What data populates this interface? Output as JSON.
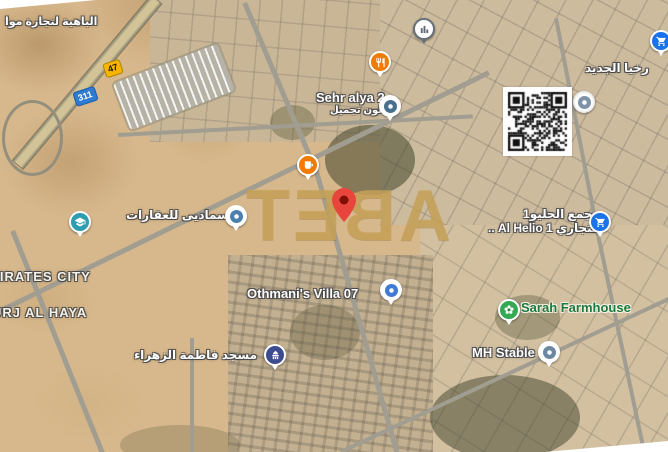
{
  "app": {
    "type": "satellite-map-view"
  },
  "watermark": {
    "text": "TEBA",
    "letters": [
      "T",
      "E",
      "B",
      "A"
    ],
    "color": "#c8a35c"
  },
  "route_badges": [
    {
      "number": "47",
      "style": "highway-yellow"
    },
    {
      "number": "311",
      "style": "route-blue"
    }
  ],
  "labels": [
    {
      "name": "label-al-bahia-trading",
      "text": "الباهية لتجارة موا",
      "x": 5,
      "y": 15,
      "size": 11,
      "style": "white",
      "rtl": true
    },
    {
      "name": "label-sehr-alya-2",
      "text": "Sehr alya 2",
      "x": 316,
      "y": 90,
      "size": 13,
      "style": "white"
    },
    {
      "name": "label-sehr-alya-2-ar",
      "text": "صالون تجميل",
      "x": 330,
      "y": 105,
      "size": 10,
      "style": "white",
      "rtl": true
    },
    {
      "name": "label-al-jadeed",
      "text": "رخيا الجديد",
      "x": 585,
      "y": 61,
      "size": 12,
      "style": "white",
      "rtl": true
    },
    {
      "name": "label-majma-al-helio-1",
      "text": "مجمع الحليو1",
      "x": 523,
      "y": 207,
      "size": 12,
      "style": "white",
      "rtl": true
    },
    {
      "name": "label-al-helio-1-commercial",
      "text": "التجاري Al Helio 1 ..",
      "x": 488,
      "y": 221,
      "size": 12,
      "style": "white",
      "rtl": true
    },
    {
      "name": "label-samadi-real-estate",
      "text": "سماديى للعقارات",
      "x": 126,
      "y": 208,
      "size": 12,
      "style": "white",
      "rtl": true
    },
    {
      "name": "label-emirates-city",
      "text": "MIRATES CITY",
      "x": -12,
      "y": 269,
      "size": 13,
      "style": "city"
    },
    {
      "name": "label-burj-al-haya",
      "text": "URJ AL HAYA",
      "x": -8,
      "y": 305,
      "size": 13,
      "style": "city"
    },
    {
      "name": "label-othmanis-villa-07",
      "text": "Othmani's Villa 07",
      "x": 247,
      "y": 286,
      "size": 13,
      "style": "white"
    },
    {
      "name": "label-fatima-alzahra-mosque",
      "text": "مسجد فاطمة الزهراء",
      "x": 134,
      "y": 348,
      "size": 12,
      "style": "white",
      "rtl": true
    },
    {
      "name": "label-sarah-farmhouse",
      "text": "Sarah Farmhouse",
      "x": 521,
      "y": 300,
      "size": 13,
      "style": "green"
    },
    {
      "name": "label-mh-stable",
      "text": "MH Stable",
      "x": 472,
      "y": 345,
      "size": 13,
      "style": "white"
    }
  ],
  "markers": [
    {
      "name": "building-poi-marker",
      "icon": "building-icon",
      "x": 424,
      "y": 29,
      "bg": "#ffffff",
      "ring": "#667078",
      "iconColor": "#5c6670"
    },
    {
      "name": "restaurant-marker",
      "icon": "restaurant-icon",
      "x": 380,
      "y": 62,
      "bg": "#f07c02",
      "ring": "#ffffff",
      "iconColor": "#ffffff"
    },
    {
      "name": "cafe-marker",
      "icon": "cafe-icon",
      "x": 308,
      "y": 165,
      "bg": "#f07c02",
      "ring": "#ffffff",
      "iconColor": "#ffffff"
    },
    {
      "name": "sehr-alya-pin",
      "icon": "dot-icon",
      "x": 390,
      "y": 106,
      "bg": "#ffffff",
      "ring": "#ffffff",
      "iconColor": "#47708c"
    },
    {
      "name": "school-marker",
      "icon": "school-icon",
      "x": 80,
      "y": 222,
      "bg": "#2d9db0",
      "ring": "#ffffff",
      "iconColor": "#ffffff"
    },
    {
      "name": "samadi-pin",
      "icon": "dot-icon",
      "x": 236,
      "y": 216,
      "bg": "#ffffff",
      "ring": "#ffffff",
      "iconColor": "#4a7fae"
    },
    {
      "name": "supermarket-marker-top-right",
      "icon": "cart-icon",
      "x": 661,
      "y": 41,
      "bg": "#1a73e8",
      "ring": "#ffffff",
      "iconColor": "#ffffff"
    },
    {
      "name": "covered-poi-marker",
      "icon": "dot-icon",
      "x": 584,
      "y": 102,
      "bg": "#ffffff",
      "ring": "#ededed",
      "iconColor": "#7e93a8",
      "noTail": true,
      "z": 30
    },
    {
      "name": "supermarket-marker-helio",
      "icon": "cart-icon",
      "x": 600,
      "y": 222,
      "bg": "#1a73e8",
      "ring": "#ffffff",
      "iconColor": "#ffffff"
    },
    {
      "name": "othmani-villa-pin",
      "icon": "dot-icon",
      "x": 391,
      "y": 290,
      "bg": "#ffffff",
      "ring": "#ffffff",
      "iconColor": "#3f7ad6"
    },
    {
      "name": "farmhouse-marker",
      "icon": "flower-icon",
      "x": 509,
      "y": 310,
      "bg": "#34a853",
      "ring": "#ffffff",
      "iconColor": "#ffffff"
    },
    {
      "name": "mh-stable-pin",
      "icon": "dot-icon",
      "x": 549,
      "y": 352,
      "bg": "#ffffff",
      "ring": "#ffffff",
      "iconColor": "#6d87a0"
    },
    {
      "name": "mosque-marker",
      "icon": "mosque-icon",
      "x": 275,
      "y": 355,
      "bg": "#3d4c8f",
      "ring": "#ffffff",
      "iconColor": "#ffffff"
    }
  ],
  "main_pin": {
    "name": "selected-location-pin",
    "x": 344,
    "tipY": 222,
    "color": "#e8453c",
    "dotColor": "#7c1007"
  },
  "qr_code": {
    "x": 503,
    "y": 87,
    "size": 65
  }
}
